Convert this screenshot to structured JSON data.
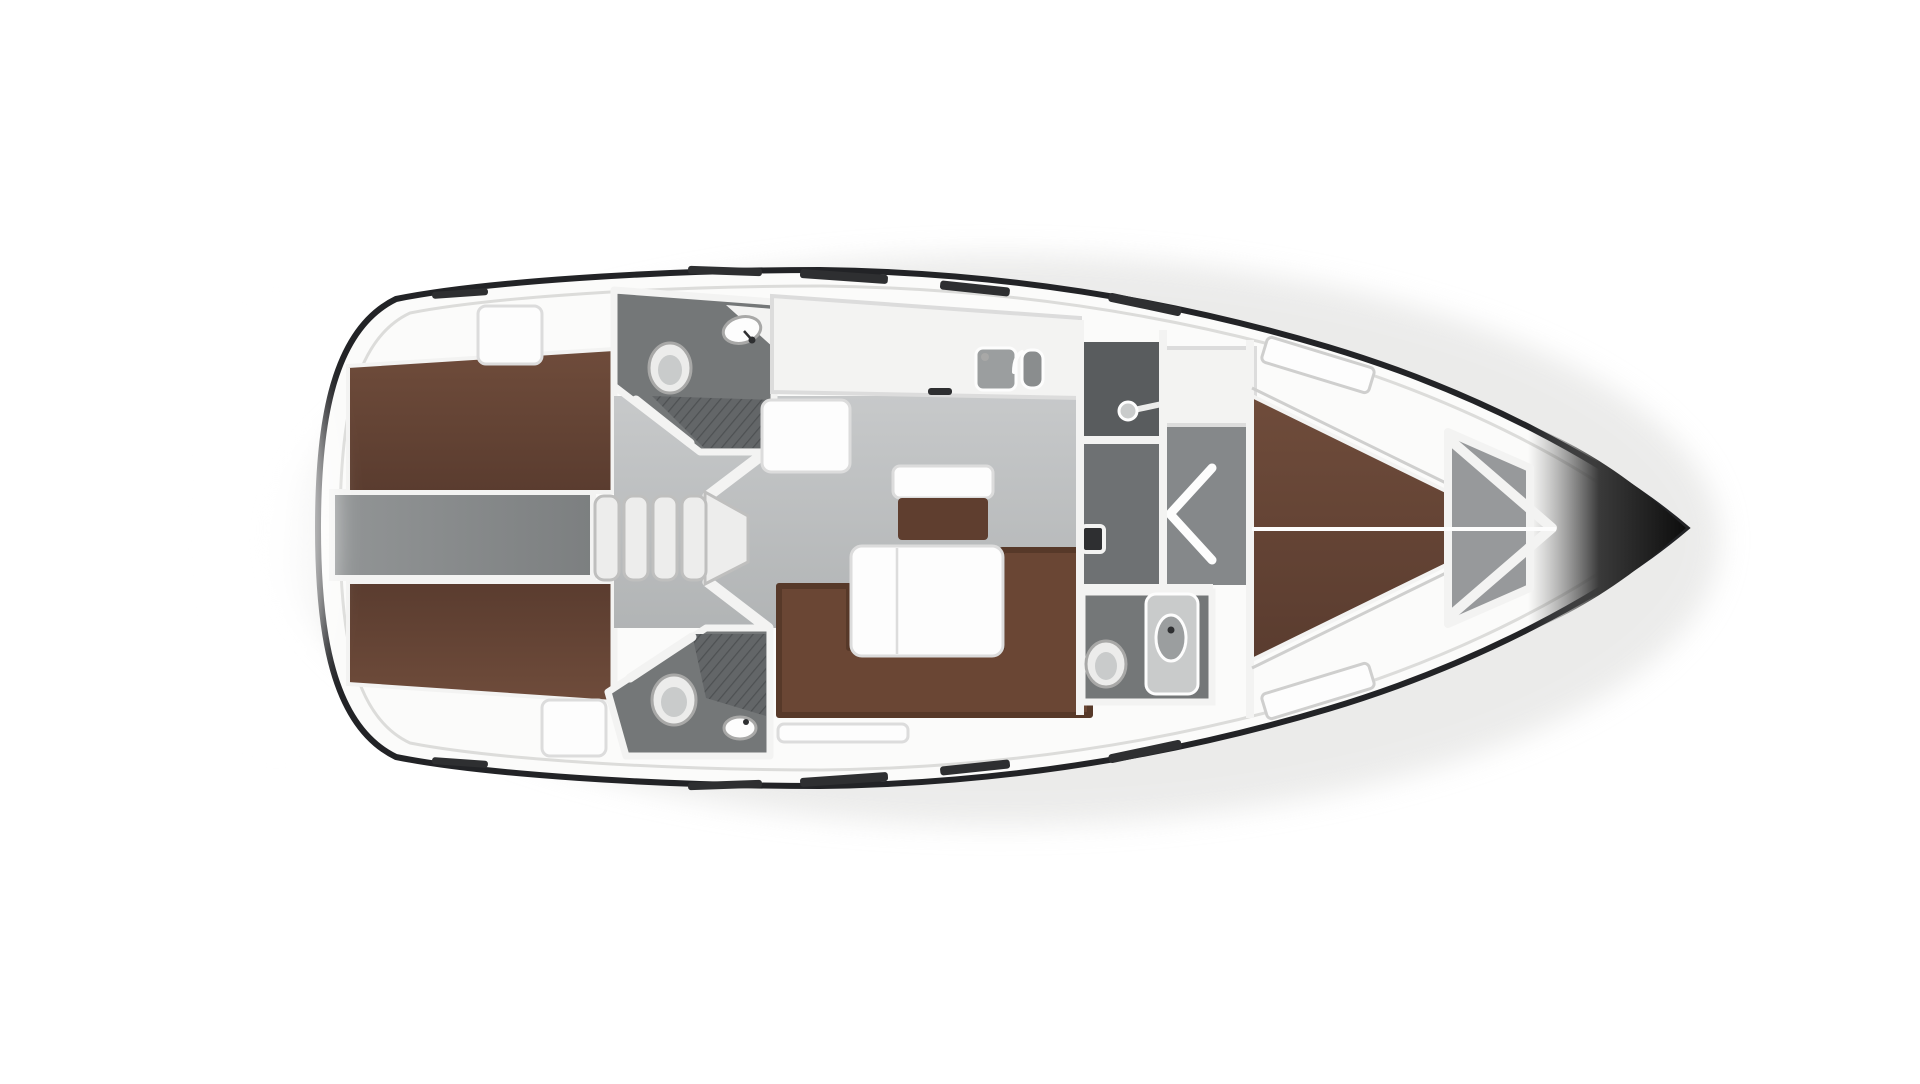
{
  "image": {
    "type": "yacht-deck-plan",
    "description": "Top-down interior layout rendering of a sailing yacht hull, bow pointing right, on a white background. No text labels are rendered in the image.",
    "background": "#ffffff"
  },
  "colors": {
    "hull_line": "#222326",
    "deck_fill": "#fbfbfa",
    "deck_line": "#dcdcda",
    "wall_white": "#f3f3f2",
    "wall_edge": "#cfcfce",
    "salon_floor": "#c7c9ca",
    "salon_floor_deep": "#a9acad",
    "corridor_floor": "#6e7173",
    "wardrobe_floor": "#595c5e",
    "shower_floor": "#85888a",
    "head_floor": "#747778",
    "hatch_base": "#636668",
    "hatch_line": "#4e5153",
    "engine_floor": "#929596",
    "engine_deep": "#7c7f80",
    "bed_brown": "#6f4c3b",
    "bed_brown_deep": "#5a3c2f",
    "sofa_brown": "#6a4634",
    "sofa_brown_deep": "#573929",
    "island_brown": "#5f3e2f",
    "furniture_white": "#fdfdfd",
    "furniture_edge": "#dcdcdc",
    "step_fill": "#ededec",
    "step_edge": "#bfbfbe",
    "fixture_white": "#ececeb",
    "fixture_rim": "#a8a8a7",
    "fixture_inner": "#c9cbcb",
    "sink_gray": "#9b9e9f",
    "sink_deep": "#8a8d8e",
    "bow_dark": "#0d0d0d",
    "bow_mid": "#3a3a3a",
    "locker_floor": "#97999b",
    "dash_dark": "#2e2f31",
    "glow_white": "#ffffff"
  },
  "rooms": [
    {
      "id": "aft-cabin-port",
      "label": "aft double cabin (top)"
    },
    {
      "id": "aft-cabin-starboard",
      "label": "aft double cabin (bottom)"
    },
    {
      "id": "engine-compartment",
      "label": "engine / companionway trunk between aft cabins"
    },
    {
      "id": "aft-head-port",
      "label": "aft head with toilet, corner sink and shower grate (top)"
    },
    {
      "id": "aft-head-starboard",
      "label": "aft head with toilet, sink and shower grate (bottom)"
    },
    {
      "id": "companionway",
      "label": "companionway entry steps"
    },
    {
      "id": "salon",
      "label": "main salon"
    },
    {
      "id": "galley",
      "label": "galley counter with double sink"
    },
    {
      "id": "chart-table",
      "label": "chart table"
    },
    {
      "id": "dinette",
      "label": "dinette table with L-sofa and island seat"
    },
    {
      "id": "corridor",
      "label": "mid corridor"
    },
    {
      "id": "wardrobe",
      "label": "wardrobe locker with hanging rod"
    },
    {
      "id": "shower-room",
      "label": "separate shower compartment with bi-fold door"
    },
    {
      "id": "forward-head",
      "label": "forward head with toilet and vanity sink"
    },
    {
      "id": "forward-cabin",
      "label": "forward V-berth cabin"
    },
    {
      "id": "anchor-locker",
      "label": "anchor locker"
    },
    {
      "id": "bow",
      "label": "bow tip"
    }
  ],
  "fixtures": {
    "companionway_steps": 4,
    "toilets": 3,
    "head_sinks": 3,
    "galley_sink_basins": 2,
    "deck_hatches": 2,
    "berths_double": 3
  }
}
